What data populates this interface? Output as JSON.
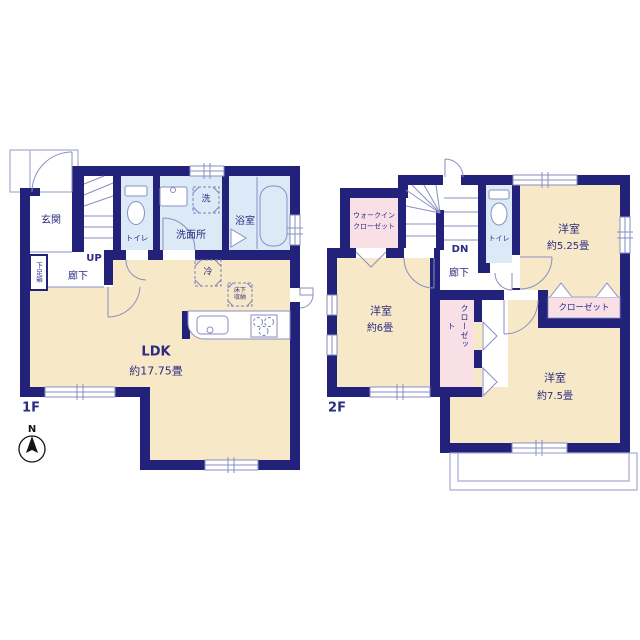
{
  "colors": {
    "wall": "#22227b",
    "floor": "#f7e8c7",
    "wet_area": "#dceaf7",
    "closet": "#f9e0e6",
    "outline": "#8a8ec2",
    "text": "#2b2b80"
  },
  "floor1": {
    "label": "1F",
    "compass": "N",
    "entrance": "玄関",
    "shoe_box": "下足箱",
    "hallway": "廊下",
    "stairs": "UP",
    "toilet": "トイレ",
    "washroom": "洗面所",
    "washer": "洗",
    "bathroom": "浴室",
    "refrigerator": "冷",
    "underfloor_storage_line1": "床下",
    "underfloor_storage_line2": "収納",
    "ldk": "LDK",
    "ldk_size": "約17.75畳"
  },
  "floor2": {
    "label": "2F",
    "stairs": "DN",
    "hallway": "廊下",
    "toilet": "トイレ",
    "walk_in_closet_line1": "ウォークイン",
    "walk_in_closet_line2": "クローゼット",
    "bedroom_525": "洋室",
    "bedroom_525_size": "約5.25畳",
    "closet_525": "クローゼット",
    "bedroom_6": "洋室",
    "bedroom_6_size": "約6畳",
    "closet_vertical": "クローゼット",
    "bedroom_75": "洋室",
    "bedroom_75_size": "約7.5畳"
  }
}
